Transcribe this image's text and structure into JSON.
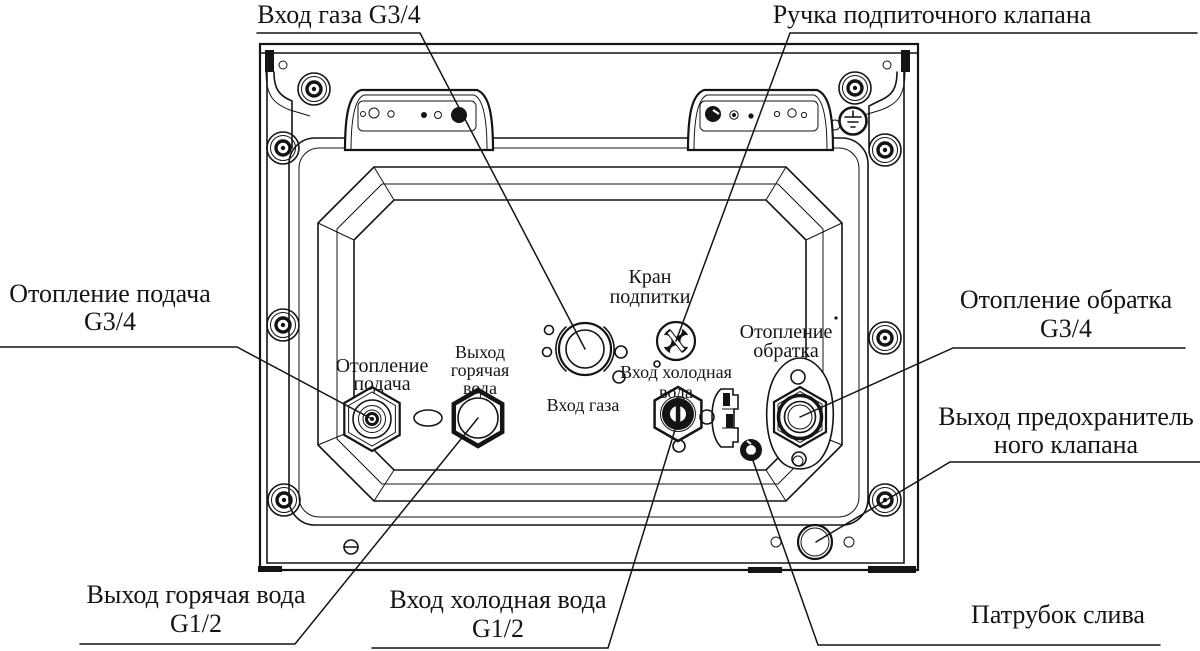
{
  "callouts": {
    "gas_inlet": {
      "label": "Вход газа G3/4"
    },
    "makeup_valve_handle": {
      "label": "Ручка подпиточного клапана"
    },
    "heating_supply": {
      "label": "Отопление подача",
      "size": "G3/4"
    },
    "heating_return": {
      "label": "Отопление обратка",
      "size": "G3/4"
    },
    "safety_valve_outlet": {
      "line1": "Выход предохранитель",
      "line2": "ного клапана"
    },
    "hot_water_outlet": {
      "label": "Выход горячая вода",
      "size": "G1/2"
    },
    "cold_water_inlet": {
      "label": "Вход холодная вода",
      "size": "G1/2"
    },
    "drain_pipe": {
      "label": "Патрубок слива"
    }
  },
  "part_labels": {
    "makeup_valve": {
      "line1": "Кран",
      "line2": "подпитки"
    },
    "heating_return": {
      "line1": "Отопление",
      "line2": "обратка"
    },
    "cold_water": {
      "line1": "Вход холодная",
      "line2": "вода"
    },
    "gas_inlet": {
      "line1": "Вход газа"
    },
    "heating_supply": {
      "line1": "Отопление",
      "line2": "подача"
    },
    "hot_water": {
      "line1": "Выход",
      "line2": "горячая",
      "line3": "вода"
    }
  },
  "colors": {
    "ink": "#141414",
    "background": "#ffffff"
  }
}
